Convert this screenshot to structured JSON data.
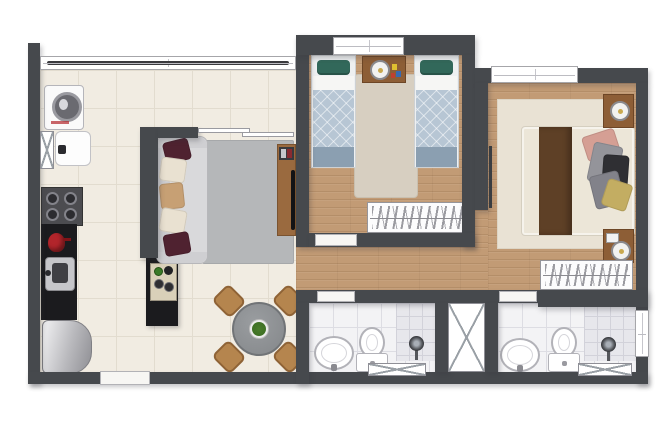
{
  "image_type": "apartment floor plan, top-down furnished 3D render, no text labels",
  "palette": {
    "wall": "#46494d",
    "tile_floor": "#f1ece2",
    "tile_line": "#e2dccf",
    "wood_floor": "#c29b75",
    "bath_floor": "#f3f3f5",
    "bath_line": "#dddde3",
    "shower_floor": "#e7e7ec",
    "rug_living": "#b5b7b9",
    "rug_twin": "#d7cfc1",
    "rug_master": "#e9e2d4",
    "sofa_gray": "#d9d9db",
    "quilt_blue": "#b7c6d4",
    "quilt_band": "#8b9fb1",
    "pillow_teal": "#32685a",
    "pillow_maroon": "#4f2230",
    "pillow_cream": "#e9e1d1",
    "pillow_tan": "#c7a074",
    "bed_cream": "#ece6d8",
    "runner_brown": "#5e4026",
    "furniture_wood": "#8d5e36",
    "rack_wood": "#9a6a3f",
    "chair_wood": "#b5854e",
    "table_gray": "#8f9295",
    "plant_green": "#3a6b21",
    "counter_black": "#1b1b1e",
    "kettle_red": "#b2252b",
    "window_frame": "#a6a6aa",
    "glass_dark": "#3a3a3e"
  },
  "rooms": [
    {
      "name": "balcony-laundry-area",
      "floor": "ceramic tile",
      "items": [
        "washing-machine",
        "laundry-tub",
        "glass-railing-window",
        "utility-duct"
      ]
    },
    {
      "name": "kitchen",
      "floor": "ceramic tile",
      "items": [
        "four-burner-cooktop",
        "black-countertop",
        "red-kettle",
        "stainless-sink",
        "refrigerator",
        "island-counter"
      ]
    },
    {
      "name": "living-dining-room",
      "floor": "ceramic tile",
      "items": [
        "sofa-with-throw-pillows",
        "gray-area-rug",
        "tv-stand-with-tv",
        "round-dining-table",
        "four-wood-chairs",
        "plant-centerpiece",
        "sliding-balcony-door"
      ]
    },
    {
      "name": "twin-bedroom",
      "floor": "wood",
      "items": [
        "single-bed-left",
        "single-bed-right",
        "nightstand-with-lamp-and-toys",
        "beige-rug",
        "wardrobe-with-hangers",
        "window"
      ]
    },
    {
      "name": "master-bedroom",
      "floor": "wood",
      "items": [
        "double-bed-with-brown-runner",
        "pillow-cluster",
        "nightstand-upper",
        "nightstand-lower",
        "round-lamps",
        "cream-rug",
        "wardrobe-with-hangers",
        "window"
      ]
    },
    {
      "name": "hallway",
      "floor": "wood",
      "items": []
    },
    {
      "name": "bathroom-social",
      "floor": "white tile",
      "items": [
        "pedestal-sink",
        "toilet",
        "shower-head",
        "floor-vent"
      ]
    },
    {
      "name": "bathroom-suite",
      "floor": "white tile",
      "items": [
        "pedestal-sink",
        "toilet",
        "shower-head",
        "floor-vent",
        "window"
      ]
    },
    {
      "name": "service-shaft",
      "floor": "",
      "items": [
        "x-marked-duct"
      ]
    }
  ],
  "openings": {
    "entry_door": 1,
    "bedroom_door_gaps": 2,
    "bathroom_door_gaps": 2,
    "windows": 4,
    "sliding_balcony_door": 1,
    "x_marked_ducts_vents": 4
  }
}
